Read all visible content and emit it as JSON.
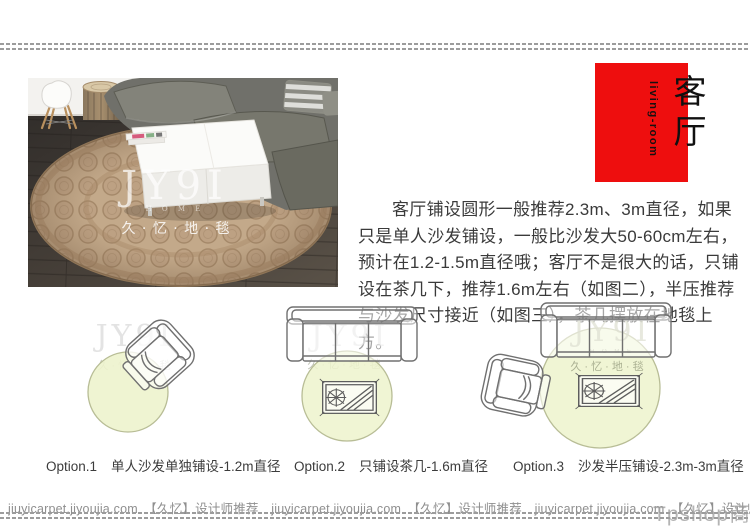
{
  "brand": {
    "logo": "JY9I",
    "home": "H O M E",
    "cn": "久 · 忆 · 地 · 毯"
  },
  "header": {
    "title_cn": "客厅",
    "title_en": "living-room",
    "accent_color": "#ee0e0e"
  },
  "description": {
    "text": "客厅铺设圆形一般推荐2.3m、3m直径，如果只是单人沙发铺设，一般比沙发大50-60cm左右，预计在1.2-1.5m直径哦；客厅不是很大的话，只铺设在茶几下，推荐1.6m左右（如图二），半压推荐与沙发尺寸接近（如图三），茶几摆放在地毯上方。"
  },
  "options": [
    {
      "label": "Option.1",
      "caption": "单人沙发单独铺设-1.2m直径"
    },
    {
      "label": "Option.2",
      "caption": "只铺设茶几-1.6m直径"
    },
    {
      "label": "Option.3",
      "caption": "沙发半压铺设-2.3m-3m直径"
    }
  ],
  "footer": {
    "line": "jiuyicarpet.jiyoujia.com　【久忆】设计师推荐　jiuyicarpet.jiyoujia.com　【久忆】设计师推荐　jiuyicarpet.jiyoujia.com　【久忆】设计师推荐　jiuyicarpet.jiyoujia.com　【久忆】设计师推荐",
    "watermark": "Tpshop商城"
  },
  "colors": {
    "accent_red": "#ee0e0e",
    "rug_circle_fill": "#edf3cd",
    "rug_circle_edge": "#b8bd96",
    "line_art": "#707070",
    "footer_text": "#8f8f8f"
  }
}
